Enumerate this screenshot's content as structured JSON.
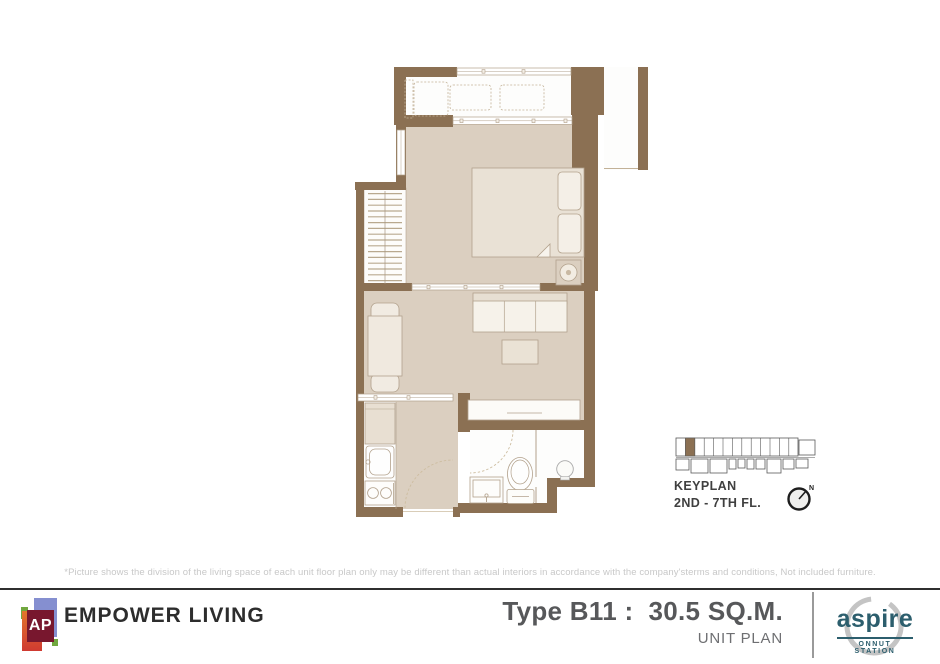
{
  "colors": {
    "wall_brown": "#8b7053",
    "floor_beige": "#dbcfc0",
    "accent_teal": "#2c5e6d",
    "title_gray": "#57585a",
    "disclaimer_gray": "#c8c8c8"
  },
  "keyplan": {
    "title": "KEYPLAN",
    "floors": "2ND - 7TH FL.",
    "compass_label": "N"
  },
  "disclaimer": "*Picture shows the division of the living space of each unit floor plan only may be different than actual interiors in accordance with the company'sterms and conditions, Not included furniture.",
  "footer": {
    "brand_logo_text": "AP",
    "brand_name": "EMPOWER LIVING",
    "unit_type": "Type B11 :  30.5 SQ.M.",
    "plan_label": "UNIT PLAN",
    "project": {
      "name": "aspire",
      "location": "ONNUT STATION"
    }
  }
}
